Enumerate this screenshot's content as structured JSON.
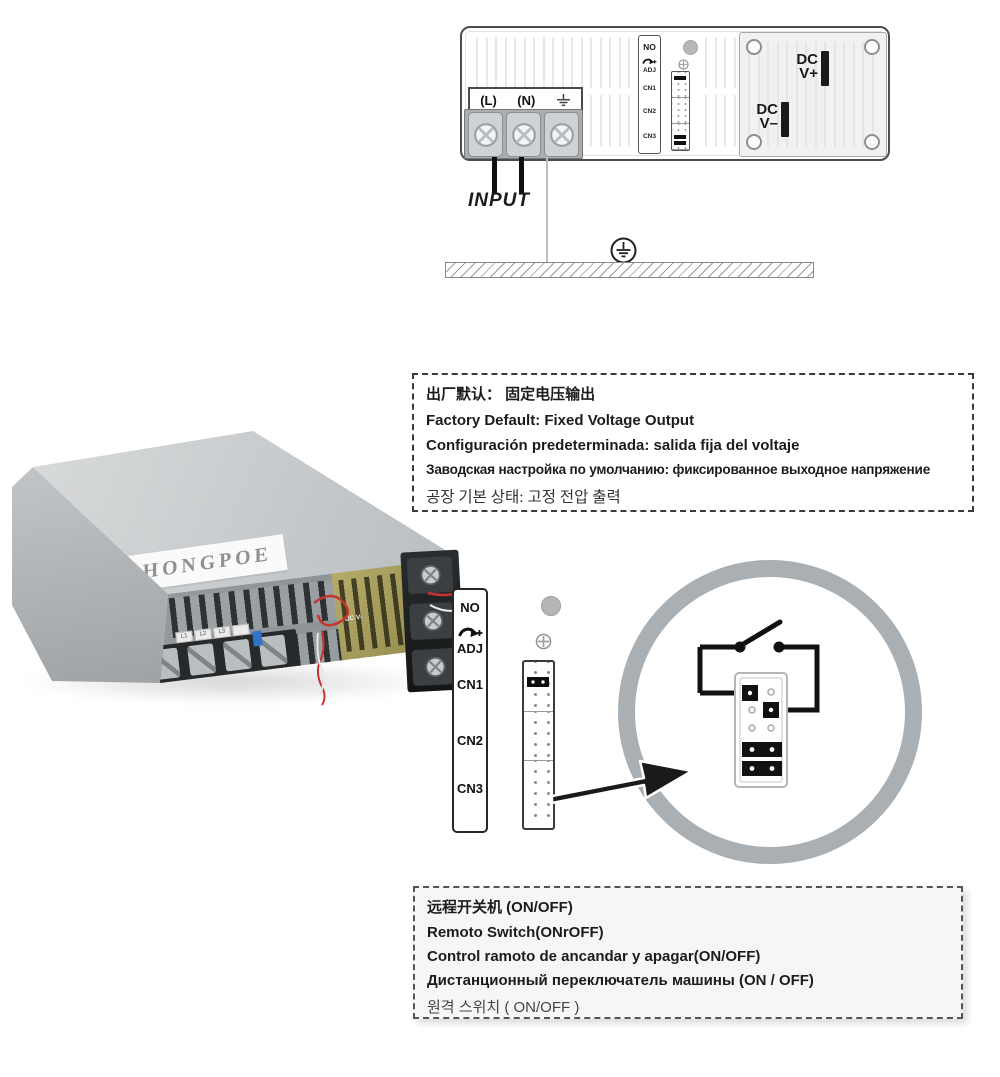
{
  "colors": {
    "ring_gray": "#a9afb3",
    "jumper_black": "#111111",
    "pcb_olive": "#a59c5e",
    "wire_red": "#c5342e",
    "chip_blue": "#2f74c9",
    "case_gray": "#c6c9cb"
  },
  "wiring": {
    "input_label": "INPUT",
    "line_label": "(L)",
    "neutral_label": "(N)",
    "dc_plus_l1": "DC",
    "dc_plus_l2": "V+",
    "dc_minus_l1": "DC",
    "dc_minus_l2": "V–"
  },
  "connector": {
    "no": "NO",
    "adj": "ADJ",
    "cn1": "CN1",
    "cn2": "CN2",
    "cn3": "CN3"
  },
  "notice_fixed": {
    "zh": "出厂默认： 固定电压输出",
    "en": "Factory Default: Fixed Voltage Output",
    "es": "Configuración predeterminada: salida fija del voltaje",
    "ru": "Заводская настройка по умолчанию: фиксированное выходное напряжение",
    "ko": "공장 기본 상태: 고정 전압 출력"
  },
  "photo": {
    "brand": "HONGPOE",
    "chips": [
      "L1",
      "L2",
      "L3",
      ""
    ],
    "pcb_plus": "DC V+",
    "pcb_minus": "DC V-"
  },
  "notice_remote": {
    "zh": "远程开关机  (ON/OFF)",
    "en": "Remoto Switch(ONrOFF)",
    "es": "Control ramoto de ancandar y apagar(ON/OFF)",
    "ru": "Дистанционный переключатель машины (ON / OFF)",
    "ko": "원격 스위치 ( ON/OFF )"
  }
}
